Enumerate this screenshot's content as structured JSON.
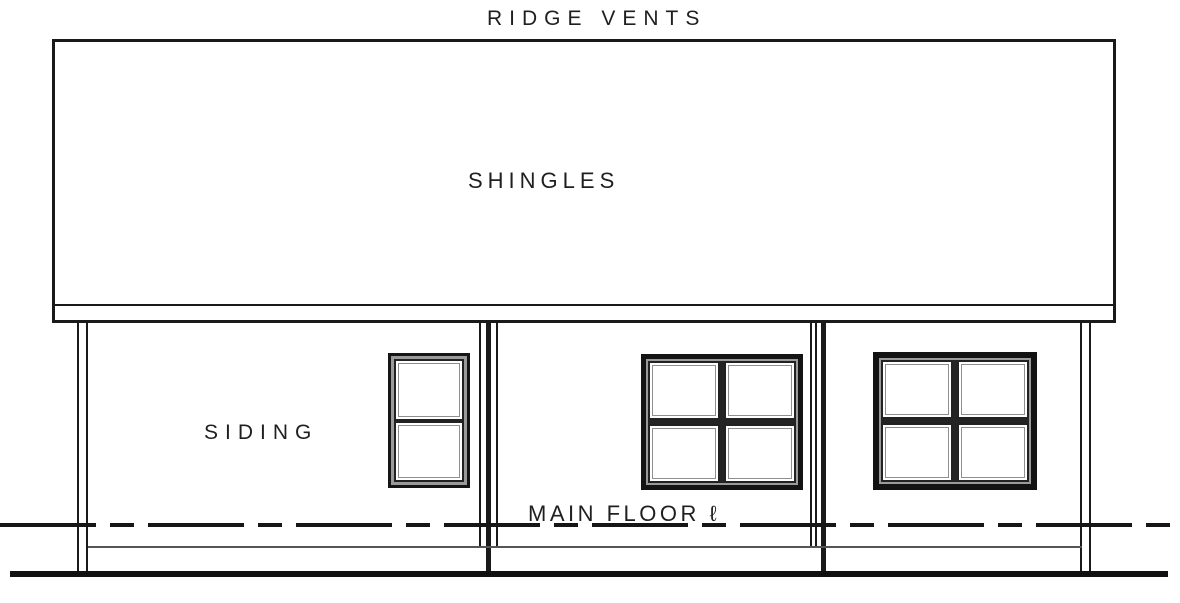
{
  "meta": {
    "drawing_type": "rear elevation line drawing"
  },
  "labels": {
    "ridge_vents": "RIDGE VENTS",
    "shingles": "SHINGLES",
    "siding": "SIDING",
    "main_floor": "MAIN FLOOR ℓ"
  },
  "colors": {
    "ink": "#1a1a1a",
    "background": "#ffffff",
    "foundation_line": "#555555",
    "window_reveal": "#9a9a9a"
  },
  "structure": {
    "roof": {
      "ridge_label": "RIDGE VENTS",
      "covering_label": "SHINGLES"
    },
    "wall_label": "SIDING",
    "floor_line_label": "MAIN FLOOR ℓ",
    "windows": [
      {
        "id": "left",
        "layout": "1x2 stacked double-hung",
        "panes": 2
      },
      {
        "id": "center",
        "layout": "2x2 four-pane",
        "panes": 4
      },
      {
        "id": "right",
        "layout": "2x2 four-pane",
        "panes": 4
      }
    ]
  }
}
